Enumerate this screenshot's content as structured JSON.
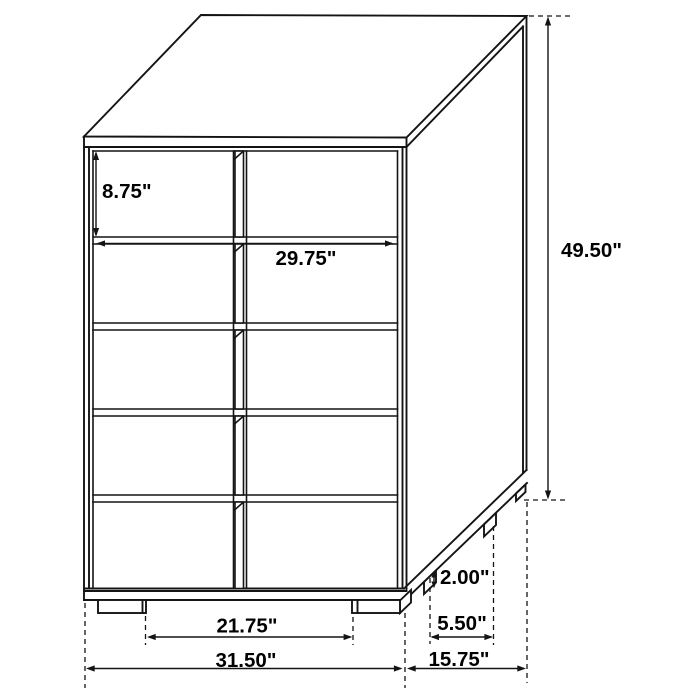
{
  "figure": {
    "kind": "furniture-dimension-diagram",
    "subject": "five-drawer-chest",
    "background_color": "#ffffff",
    "line_color": "#141414",
    "text_color": "#000000",
    "unit": "in"
  },
  "dimensions": {
    "drawer_height": {
      "label": "8.75\"",
      "value": 8.75
    },
    "drawer_width": {
      "label": "29.75\"",
      "value": 29.75
    },
    "overall_height": {
      "label": "49.50\"",
      "value": 49.5
    },
    "leg_height": {
      "label": "2.00\"",
      "value": 2.0
    },
    "side_leg_spacing": {
      "label": "5.50\"",
      "value": 5.5
    },
    "front_leg_spacing": {
      "label": "21.75\"",
      "value": 21.75
    },
    "overall_width": {
      "label": "31.50\"",
      "value": 31.5
    },
    "overall_depth": {
      "label": "15.75\"",
      "value": 15.75
    }
  }
}
